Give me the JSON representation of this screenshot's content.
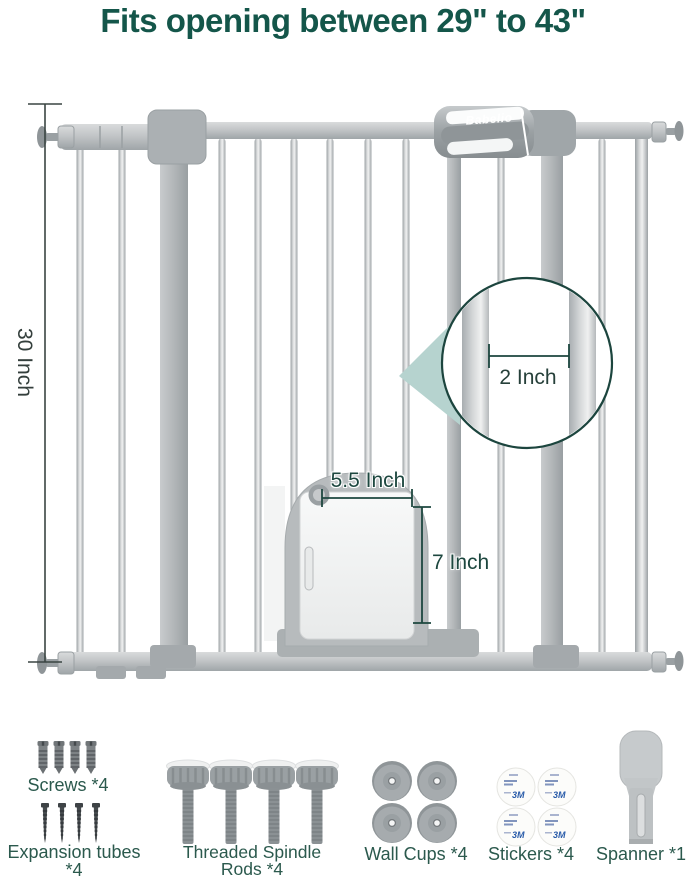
{
  "title": "Fits opening between 29\" to 43\"",
  "brand": "Babelio",
  "dimensions": {
    "gate_height": "30 Inch",
    "bar_spacing": "2 Inch",
    "pet_door_width": "5.5 Inch",
    "pet_door_height": "7 Inch"
  },
  "accessories": [
    {
      "name": "screws",
      "label": "Screws *4"
    },
    {
      "name": "expansion-tubes",
      "label": "Expansion tubes *4"
    },
    {
      "name": "threaded-spindle-rods",
      "label_line1": "Threaded Spindle",
      "label_line2": "Rods *4"
    },
    {
      "name": "wall-cups",
      "label": "Wall Cups *4"
    },
    {
      "name": "stickers",
      "label": "Stickers *4",
      "logo": "3M"
    },
    {
      "name": "spanner",
      "label": "Spanner *1"
    }
  ],
  "colors": {
    "title_green": "#14564A",
    "label_green": "#2B594D",
    "dimension_teal": "#1D473F",
    "magnifier_outline": "#1C453E",
    "wedge_teal": "#B6D3CF",
    "gate_gray": "#C9CCCE"
  }
}
